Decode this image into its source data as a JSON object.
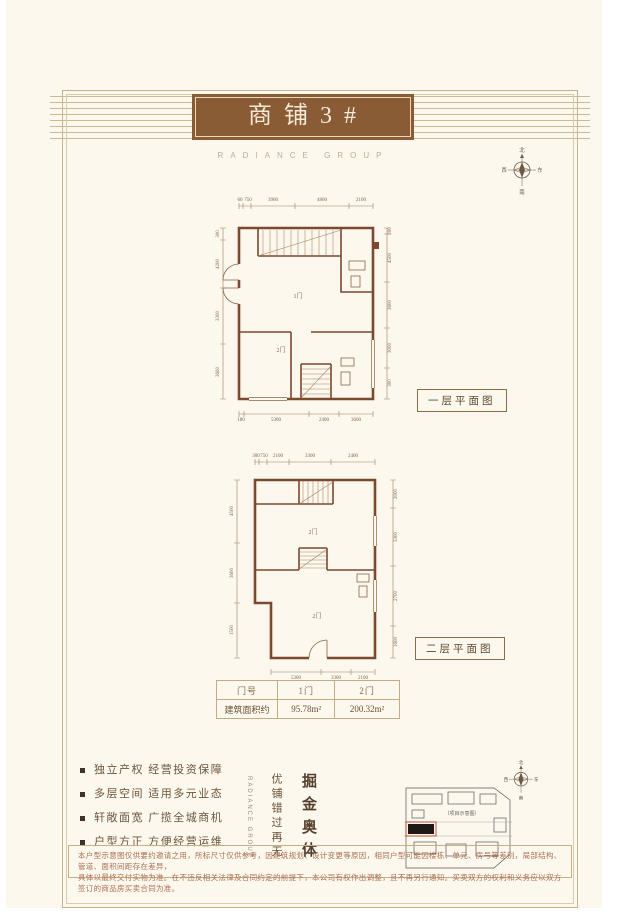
{
  "page": {
    "title": "商铺3#",
    "subtitle_en": "RADIANCE GROUP"
  },
  "compass": {
    "n": "北",
    "s": "南",
    "w": "西",
    "e": "东"
  },
  "plans": [
    {
      "name": "一层平面图",
      "rooms": [
        "1门",
        "2门"
      ],
      "dims_top": [
        "60",
        "750",
        "3900",
        "4800",
        "2100"
      ],
      "dims_left": [
        "300",
        "4200",
        "3300",
        "3600"
      ],
      "dims_right": [
        "200",
        "4500",
        "3600",
        "3000",
        "300"
      ],
      "dims_bottom": [
        "180",
        "5300",
        "2400",
        "3600"
      ]
    },
    {
      "name": "二层平面图",
      "rooms": [
        "2门",
        "2门"
      ],
      "dims_top": [
        "300",
        "750",
        "2100",
        "3300",
        "2400"
      ],
      "dims_left": [
        "4500",
        "3600",
        "1500"
      ],
      "dims_right": [
        "2000",
        "3300",
        "2700",
        "1600"
      ],
      "dims_bottom": [
        "5300",
        "3300",
        "2100"
      ]
    }
  ],
  "table": {
    "headers": [
      "门号",
      "1门",
      "2门"
    ],
    "rows": [
      [
        "建筑面积约",
        "95.78m²",
        "200.32m²"
      ]
    ]
  },
  "features": [
    "独立产权 经营投资保障",
    "多层空间 适用多元业态",
    "轩敞面宽 广揽全城商机",
    "户型方正 方便经营运维"
  ],
  "slogan": {
    "main": "掘金奥体",
    "sub": "优铺错过再无",
    "aside_en": "RADIANCE GROUP"
  },
  "siteplan": {
    "label": "（项目示意图）"
  },
  "disclaimer": {
    "line1": "本户型示意图仅供要约邀请之用，所标尺寸仅供参考，因建筑规划、设计变更等原因，相同户型可能因楼栋、单元、房号等差别，局部结构、管道、面积间距存在差异，",
    "line2": "具体以最终交付实物为准。在不违反相关法律及合同约定的前提下，本公司有权作出调整，且不再另行通知。买卖双方的权利和义务应以双方签订的商品房买卖合同为准。"
  }
}
